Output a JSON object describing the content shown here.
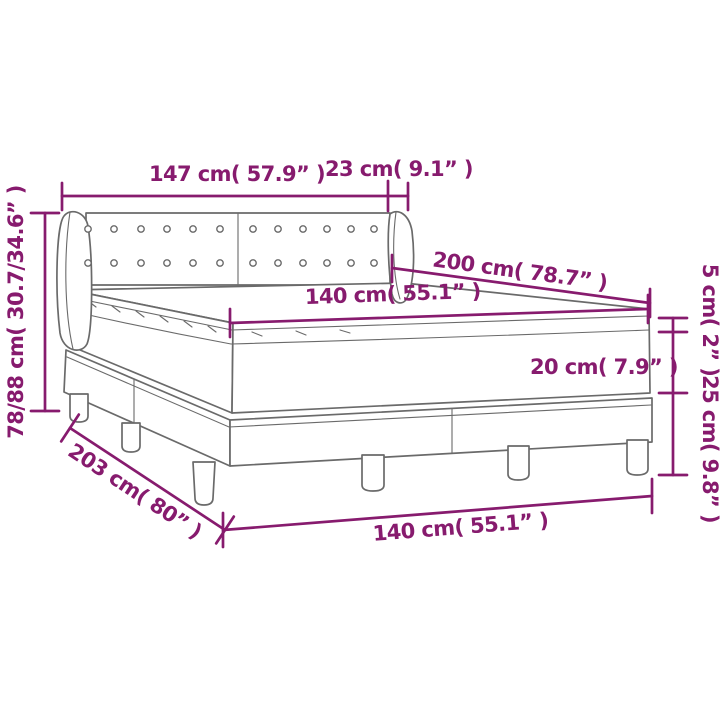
{
  "page": {
    "background": "#ffffff",
    "kind": "product dimension diagram",
    "subject": "box spring bed with button-tufted headboard, pillow-top mattress and legs"
  },
  "colors": {
    "dimension_accent": "#871b6e",
    "drawing_outline": "#6a6a6a"
  },
  "labels": {
    "headboard_width": "147 cm( 57.9” )",
    "headboard_wing_depth": "23 cm( 9.1” )",
    "headboard_height": "78/88 cm( 30.7/34.6” )",
    "bed_length": "200 cm( 78.7” )",
    "mattress_width": "140 cm( 55.1” )",
    "pillow_top_height": "5 cm( 2” )",
    "mattress_height": "20 cm( 7.9” )",
    "base_height": "25 cm( 9.8” )",
    "frame_length": "203 cm( 80” )",
    "frame_width": "140 cm( 55.1” )"
  }
}
